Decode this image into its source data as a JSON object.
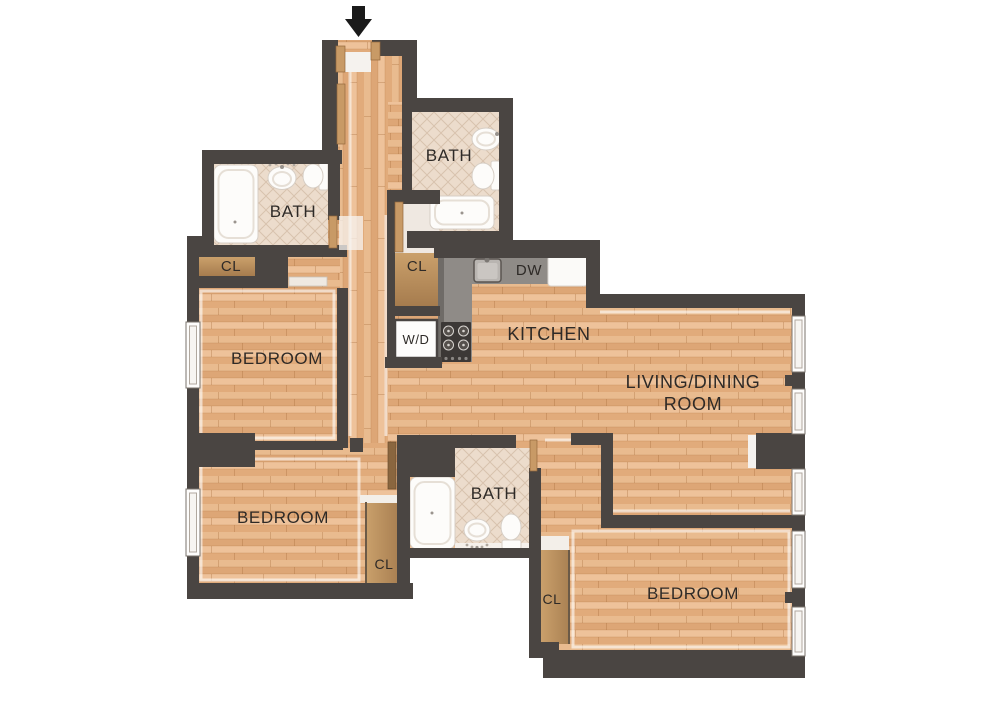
{
  "floorplan": {
    "type": "apartment-floor-plan",
    "entry": {
      "arrow_icon": "arrow-down-icon"
    },
    "labels": {
      "bath_top": "BATH",
      "bath_left": "BATH",
      "bath_middle": "BATH",
      "closet_top_left": "CL",
      "closet_hall": "CL",
      "closet_bottom_left": "CL",
      "closet_bottom_right": "CL",
      "bedroom_top_left": "BEDROOM",
      "bedroom_bottom_left": "BEDROOM",
      "bedroom_bottom_right": "BEDROOM",
      "kitchen": "KITCHEN",
      "living_dining_line1": "LIVING/DINING",
      "living_dining_line2": "ROOM",
      "washer_dryer": "W/D",
      "dishwasher": "DW"
    },
    "colors": {
      "wall": "#4a4542",
      "wood_floor": "#e4b184",
      "tile_floor": "#ecdccc",
      "counter": "#8f8b87",
      "stove": "#3c3836",
      "closet_wood": "#bf9465",
      "fixture_white": "#fdfcfa",
      "label_text": "#2e2a27",
      "arrow": "#1a1a1a",
      "background": "#ffffff"
    }
  }
}
